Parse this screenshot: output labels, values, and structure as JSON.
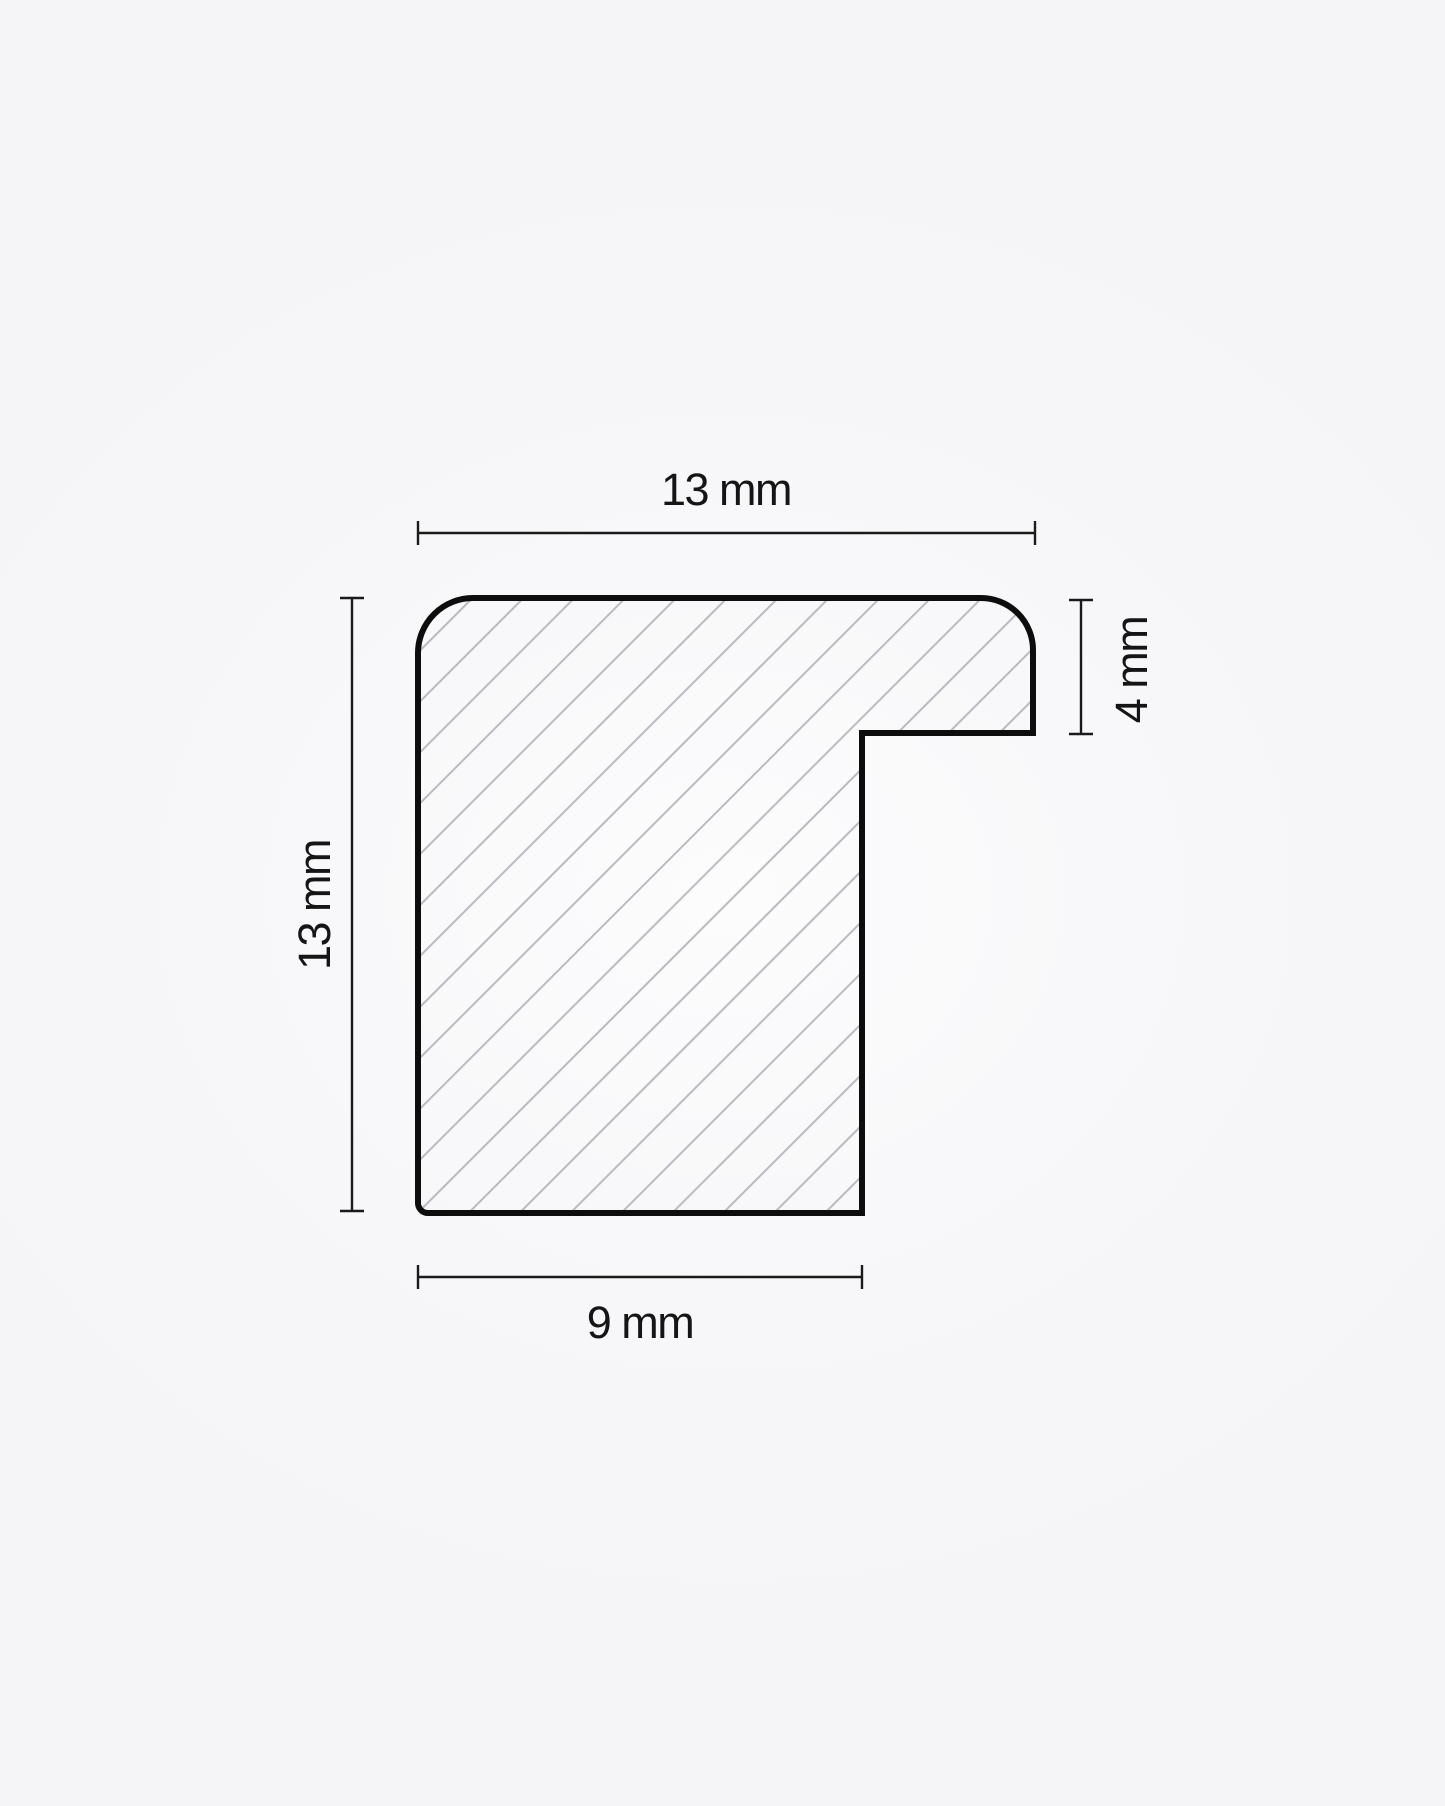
{
  "diagram": {
    "kind": "frame-profile-cross-section",
    "labels": {
      "top": "13 mm",
      "left": "13 mm",
      "right": "4 mm",
      "bottom": "9 mm"
    },
    "colors": {
      "background": "#f5f5f7",
      "outline": "#0d0d0d",
      "hatch": "#babac0",
      "dimension_line": "#1a1a1a",
      "label_text": "#151515"
    }
  }
}
